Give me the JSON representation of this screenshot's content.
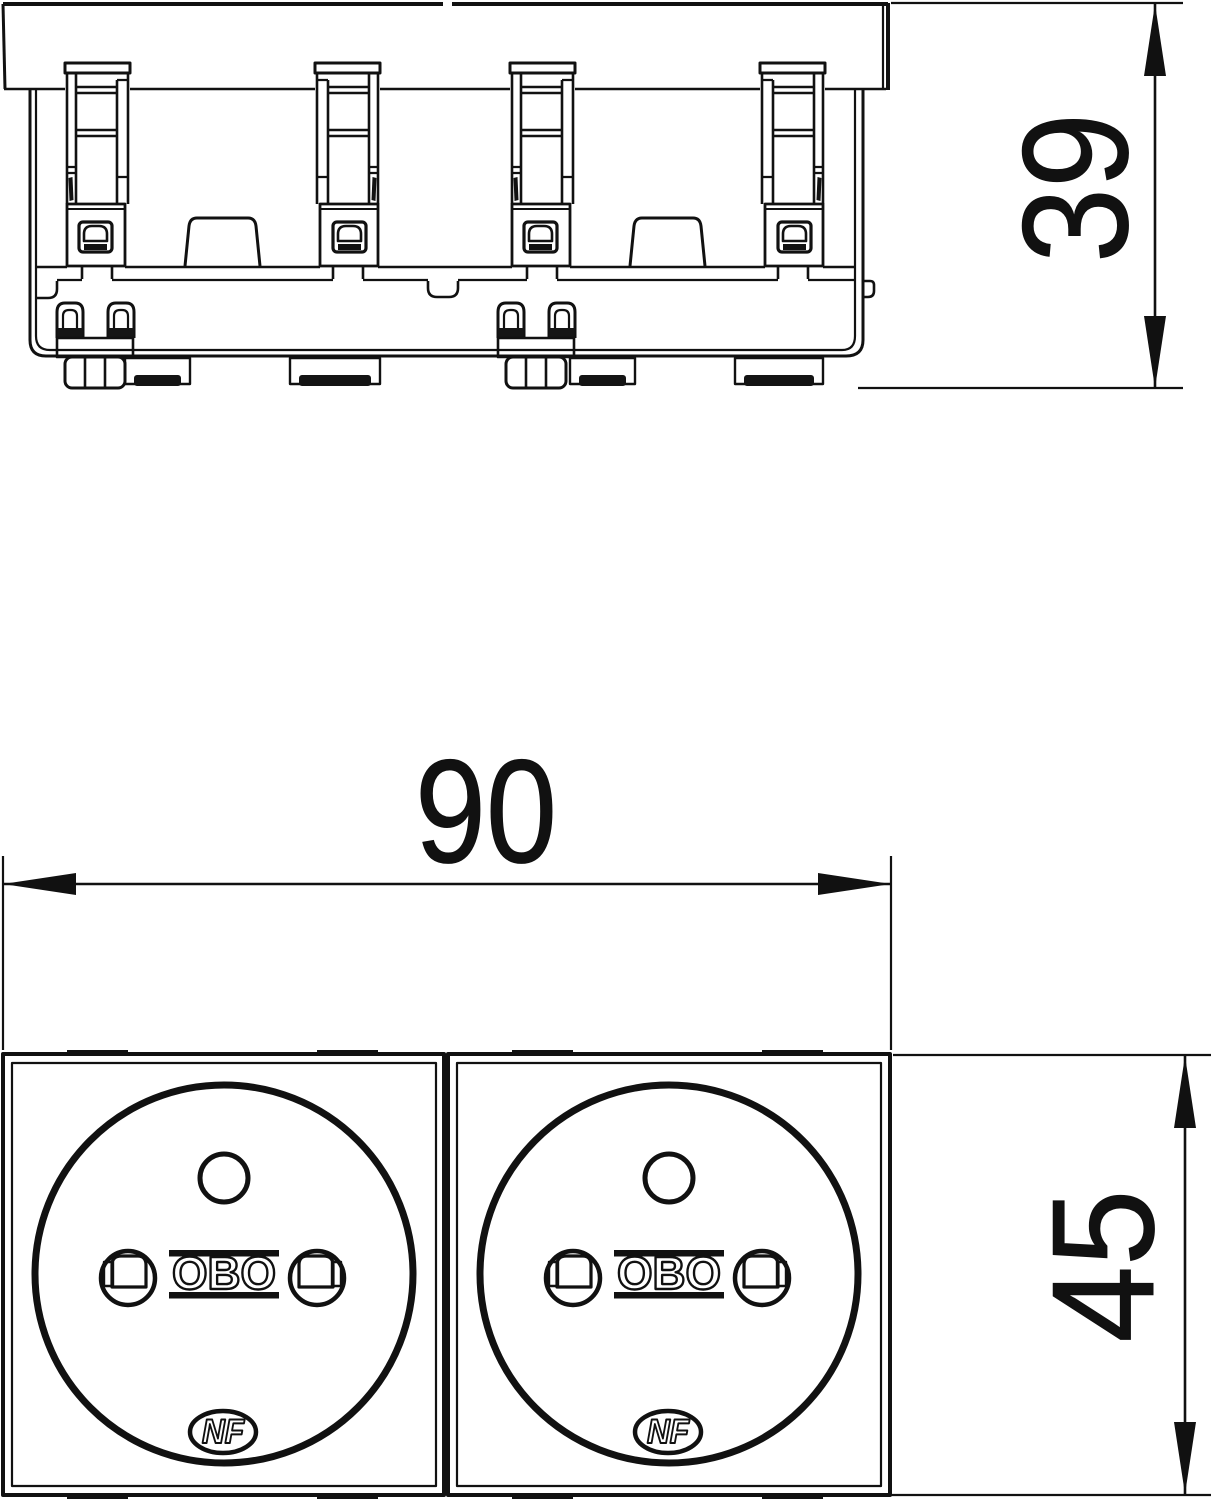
{
  "drawing": {
    "kind": "technical-dimension-drawing",
    "views": {
      "side": {
        "depth_dimension": "39"
      },
      "front": {
        "width_dimension": "90",
        "height_dimension": "45",
        "module_count": 2
      }
    },
    "branding": {
      "manufacturer_logo": "OBO",
      "certification_mark": "NF"
    },
    "colors": {
      "line": "#111111",
      "background": "#ffffff"
    }
  }
}
